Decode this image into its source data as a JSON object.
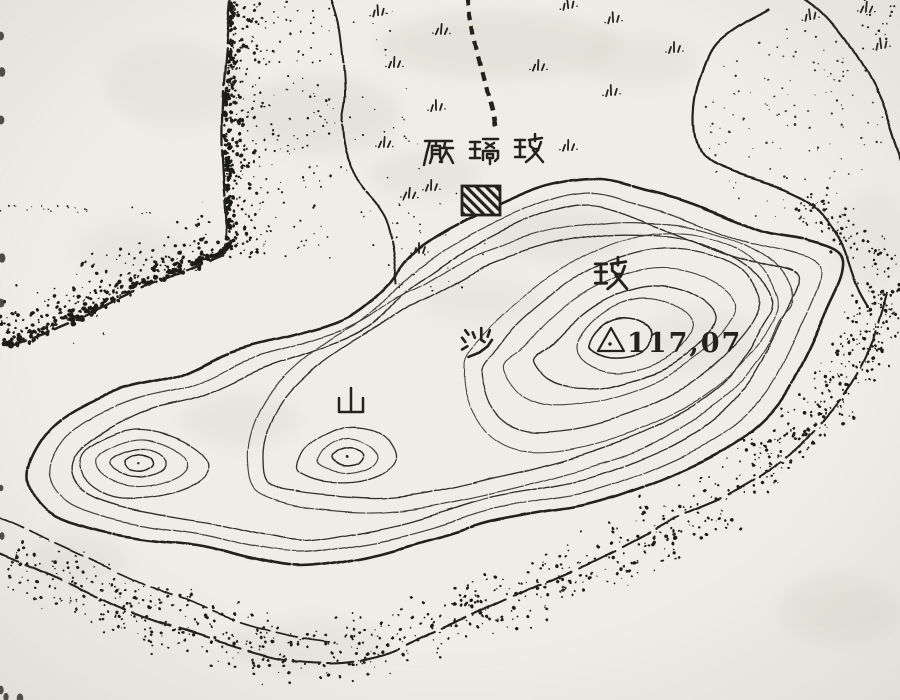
{
  "map": {
    "region_labels": {
      "factory": {
        "text": "玻璃廠",
        "reading_direction": "right-to-left",
        "display_chars": [
          "廠",
          "璃",
          "玻"
        ]
      },
      "mountain": {
        "text": "玻沙山",
        "display_chars": [
          "玻",
          "沙",
          "山"
        ]
      }
    },
    "elevation_point": {
      "marker": "triangulation-triangle-icon",
      "value": "117,07"
    },
    "symbols": {
      "building": "hatched-square-building-symbol",
      "trail": "dashed-footpath",
      "vegetation": "grass-tuft-marks",
      "sand": "stipple-dots",
      "terrain": "contour-lines",
      "coast": "broken-shoreline"
    },
    "colors": {
      "paper": "#efede6",
      "ink": "#23221b",
      "contour": "#33312a",
      "stain": "#dbd9cf"
    }
  }
}
